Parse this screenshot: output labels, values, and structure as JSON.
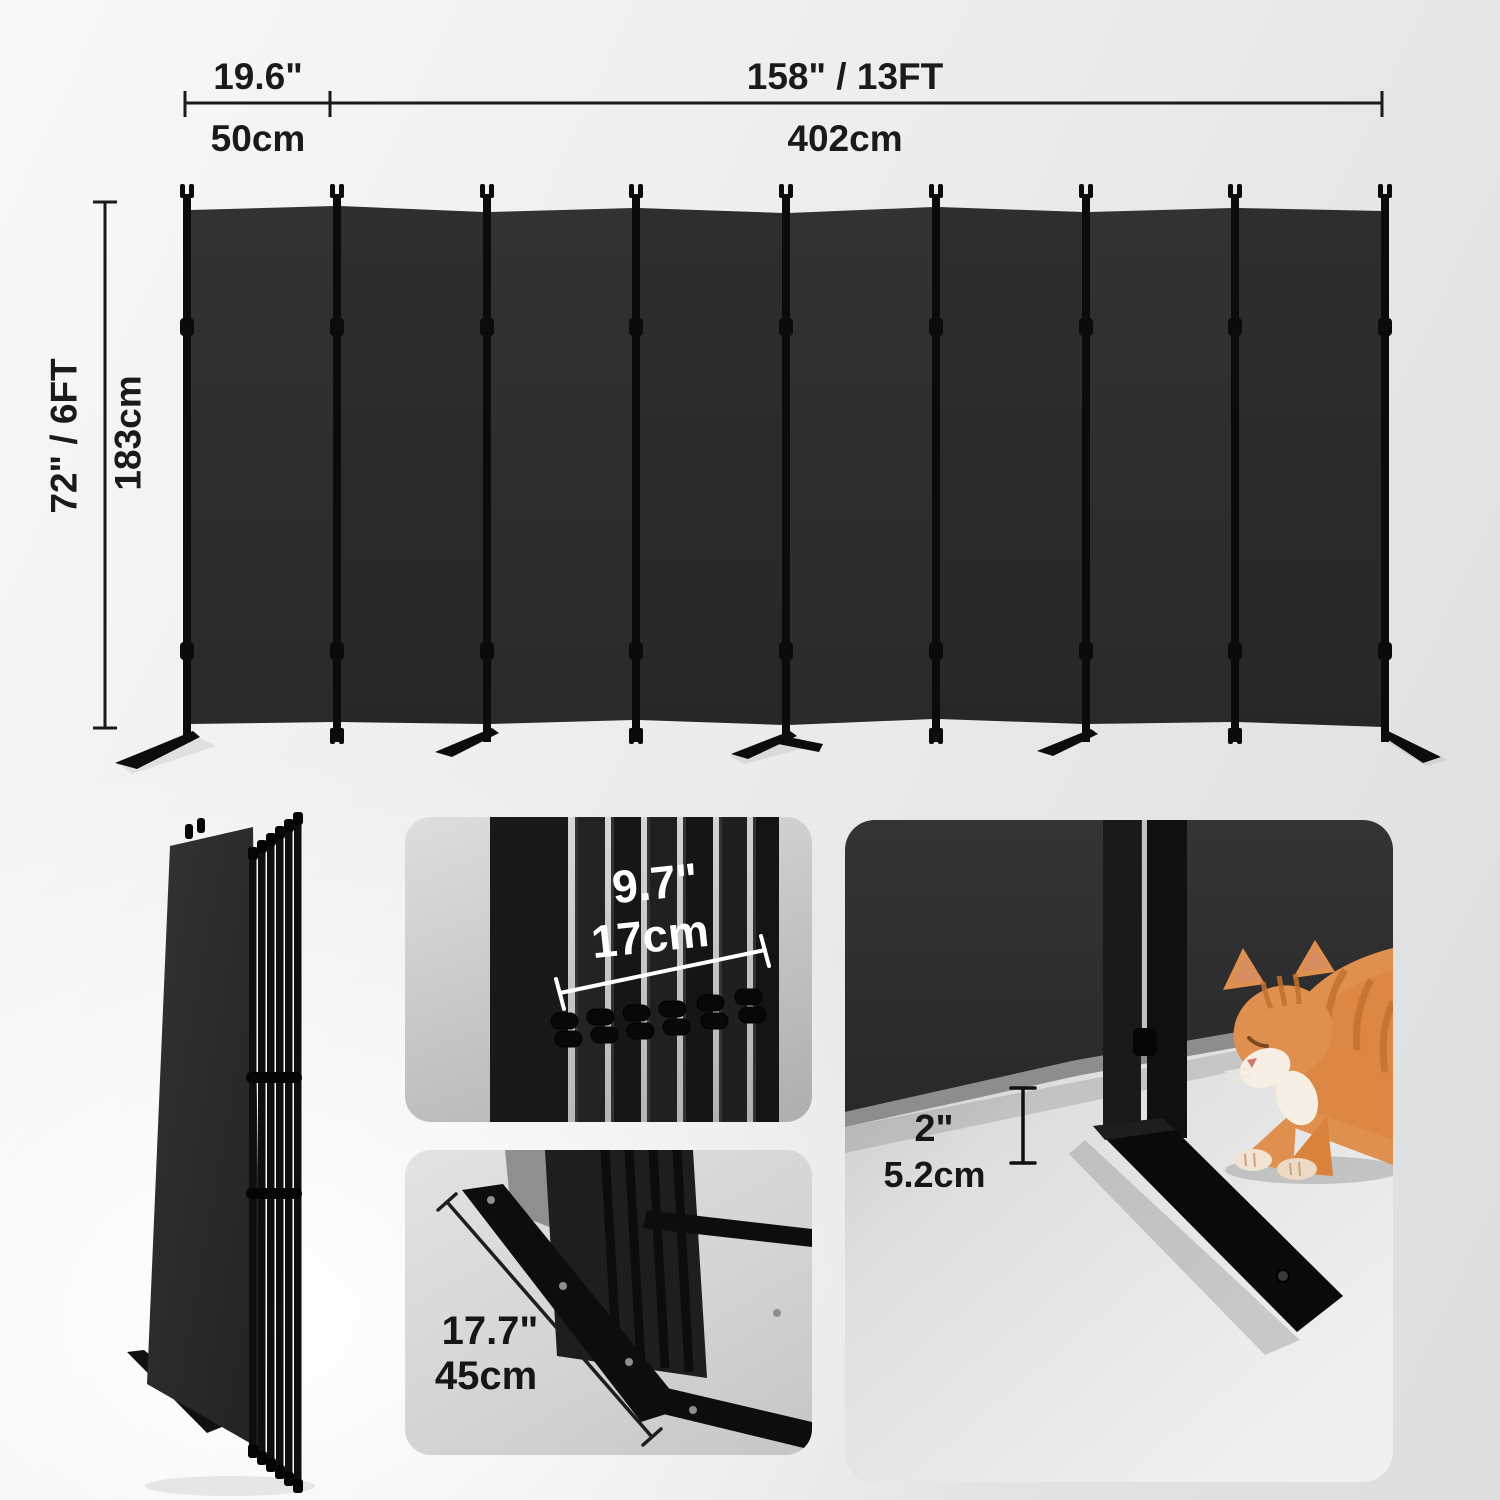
{
  "product": {
    "name": "8-Panel Folding Room Divider",
    "panel_count": 8,
    "color": "Black"
  },
  "dimensions": {
    "panel_width": {
      "inches": "19.6\"",
      "cm": "50cm"
    },
    "total_width": {
      "inches": "158\" / 13FT",
      "cm": "402cm"
    },
    "height": {
      "inches": "72\" / 6FT",
      "cm": "183cm"
    },
    "folded_depth": {
      "inches": "9.7\"",
      "cm": "17cm"
    },
    "base_length": {
      "inches": "17.7\"",
      "cm": "45cm"
    },
    "base_height": {
      "inches": "2\"",
      "cm": "5.2cm"
    }
  },
  "palette": {
    "fabric": "#2e2e2f",
    "frame": "#0b0b0b",
    "dimension_text": "#1a1a1a",
    "detail_text_light": "#ffffff",
    "card_bg": "#cfcfcf",
    "cat_fur": "#e0904e"
  }
}
